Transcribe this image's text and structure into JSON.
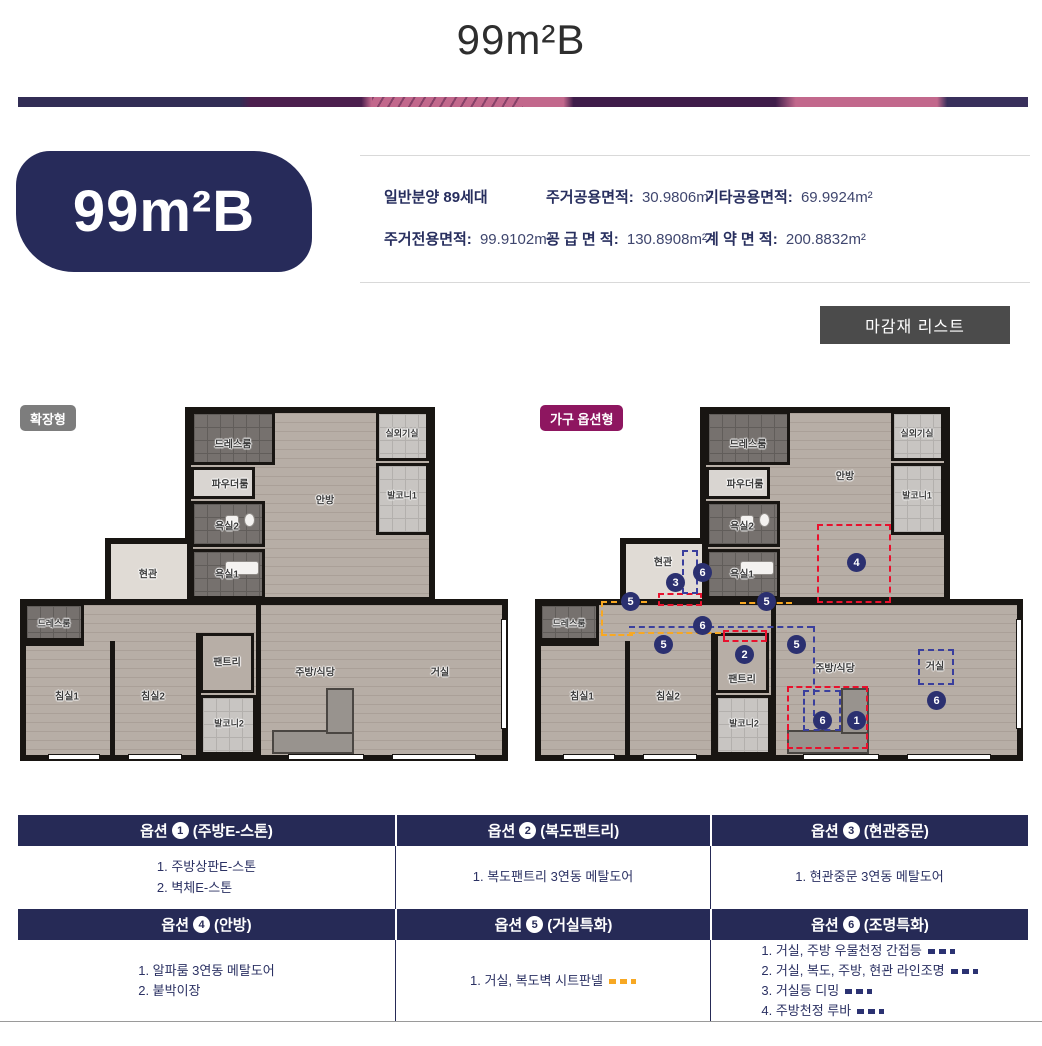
{
  "header": {
    "title": "99m²B"
  },
  "unit_badge": {
    "label": "99m²B"
  },
  "info": {
    "items": [
      {
        "label": "일반분양",
        "value": "89세대"
      },
      {
        "label": "주거공용면적:",
        "value": "30.9806m²"
      },
      {
        "label": "기타공용면적:",
        "value": "69.9924m²"
      },
      {
        "label": "주거전용면적:",
        "value": "99.9102m²"
      },
      {
        "label": "공 급 면 적:",
        "value": "130.8908m²"
      },
      {
        "label": "계 약 면 적:",
        "value": "200.8832m²"
      }
    ]
  },
  "finish_button": {
    "label": "마감재 리스트"
  },
  "plans": {
    "left": {
      "badge": "확장형",
      "rooms": [
        "드레스룸",
        "파우더룸",
        "욕실2",
        "안방",
        "실외기실",
        "발코니1",
        "현관",
        "욕실1",
        "드레스룸",
        "침실1",
        "침실2",
        "팬트리",
        "발코니2",
        "주방/식당",
        "거실"
      ]
    },
    "right": {
      "badge": "가구 옵션형",
      "rooms": [
        "드레스룸",
        "파우더룸",
        "욕실2",
        "안방",
        "실외기실",
        "발코니1",
        "현관",
        "욕실1",
        "드레스룸",
        "침실1",
        "침실2",
        "팬트리",
        "발코니2",
        "주방/식당",
        "거실"
      ],
      "markers": [
        "3",
        "6",
        "5",
        "5",
        "6",
        "5",
        "2",
        "5",
        "4",
        "6",
        "6",
        "1"
      ]
    }
  },
  "options_table": {
    "rows": [
      {
        "headers": [
          {
            "prefix": "옵션",
            "num": "1",
            "title": "(주방E-스톤)"
          },
          {
            "prefix": "옵션",
            "num": "2",
            "title": "(복도팬트리)"
          },
          {
            "prefix": "옵션",
            "num": "3",
            "title": "(현관중문)"
          }
        ],
        "cells": [
          {
            "lines": [
              {
                "text": "1. 주방상판E-스톤"
              },
              {
                "text": "2. 벽체E-스톤"
              }
            ]
          },
          {
            "lines": [
              {
                "text": "1. 복도팬트리 3연동 메탈도어"
              }
            ]
          },
          {
            "lines": [
              {
                "text": "1. 현관중문 3연동 메탈도어"
              }
            ]
          }
        ]
      },
      {
        "headers": [
          {
            "prefix": "옵션",
            "num": "4",
            "title": "(안방)"
          },
          {
            "prefix": "옵션",
            "num": "5",
            "title": "(거실특화)"
          },
          {
            "prefix": "옵션",
            "num": "6",
            "title": "(조명특화)"
          }
        ],
        "cells": [
          {
            "lines": [
              {
                "text": "1. 알파룸 3연동 메탈도어"
              },
              {
                "text": "2. 붙박이장"
              }
            ]
          },
          {
            "lines": [
              {
                "text": "1. 거실, 복도벽 시트판넬",
                "dash": "orange"
              }
            ]
          },
          {
            "lines": [
              {
                "text": "1. 거실, 주방 우물천정 간접등",
                "dash": "navy"
              },
              {
                "text": "2. 거실, 복도, 주방, 현관 라인조명",
                "dash": "navy"
              },
              {
                "text": "3. 거실등 디밍",
                "dash": "navy"
              },
              {
                "text": "4. 주방천정 루바",
                "dash": "navy"
              }
            ]
          }
        ]
      }
    ]
  },
  "colors": {
    "header_navy": "#262a56",
    "badge_navy": "#272b5a",
    "option_magenta": "#8e1660",
    "expanded_gray": "#7d7d7d",
    "button_gray": "#4b4b4b",
    "red_dash": "#e8112d",
    "blue_dash": "#3a3f9d",
    "orange_dash": "#f7a823",
    "banner_pink": "#c2688c"
  }
}
